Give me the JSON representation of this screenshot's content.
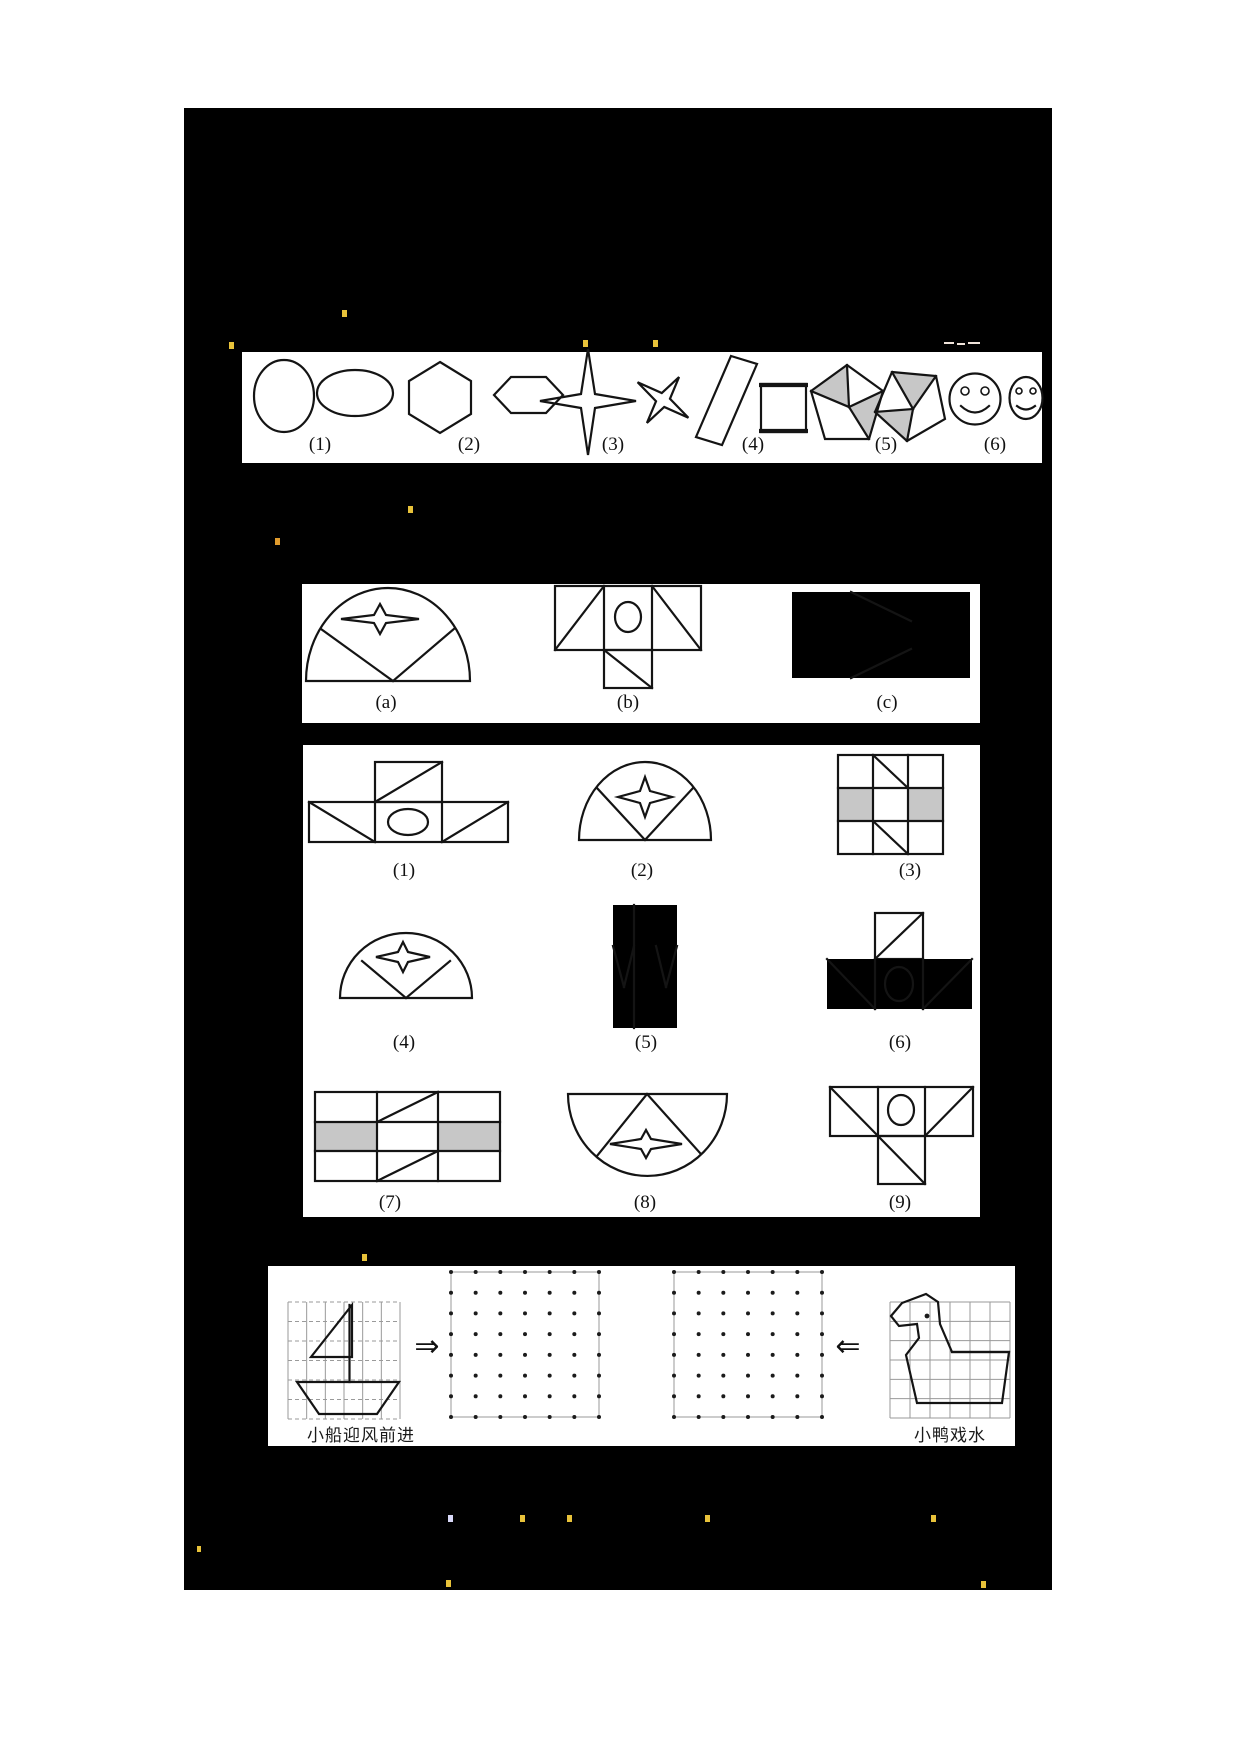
{
  "theme": {
    "page_bg": "#ffffff",
    "board_bg": "#000000",
    "panel_bg": "#ffffff",
    "stroke": "#141414",
    "shade_gray": "#c7c7c7",
    "grid_gray": "#9a9a9a",
    "mark_yellow": "#e8c23a",
    "mark_orange": "#e09b2d",
    "mark_blue": "#d8d8f8",
    "mark_white": "#efe3da"
  },
  "panel1": {
    "labels": [
      "(1)",
      "(2)",
      "(3)",
      "(4)",
      "(5)",
      "(6)"
    ]
  },
  "panel2": {
    "labels": [
      "(a)",
      "(b)",
      "(c)"
    ]
  },
  "panel3": {
    "labels": [
      "(1)",
      "(2)",
      "(3)",
      "(4)",
      "(5)",
      "(6)",
      "(7)",
      "(8)",
      "(9)"
    ]
  },
  "panel4": {
    "left_caption": "小船迎风前进",
    "right_caption": "小鸭戏水",
    "left_arrow": "⇒",
    "right_arrow": "⇐",
    "dot_grid": {
      "cols": 7,
      "rows": 8
    }
  }
}
